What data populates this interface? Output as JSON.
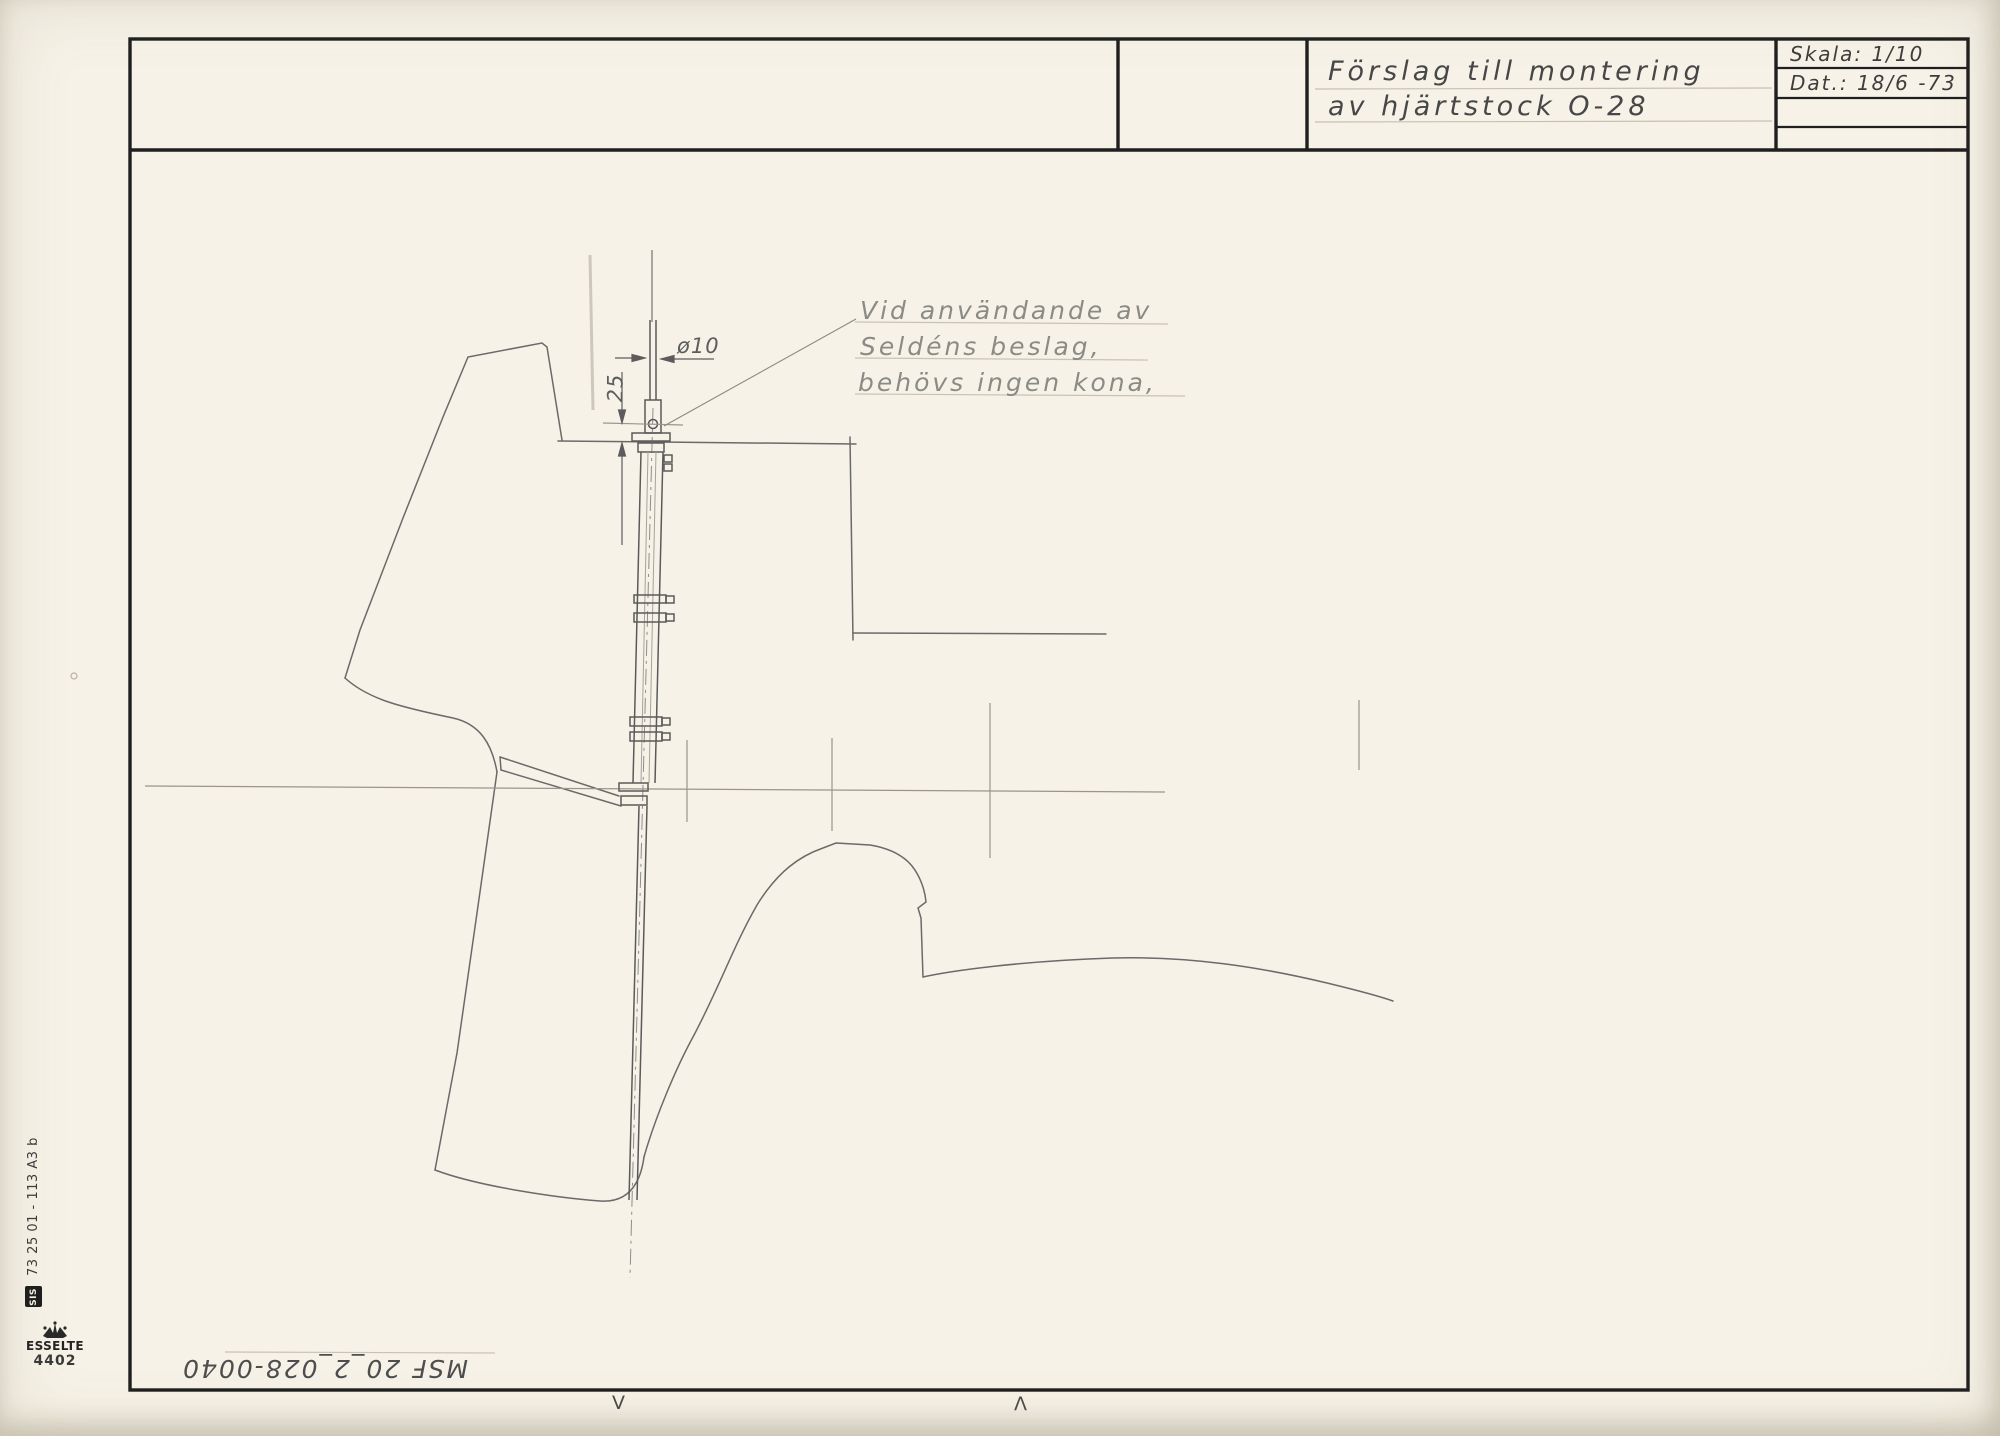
{
  "colors": {
    "paper": "#f6f2e7",
    "ink": "#1f1f1f",
    "pencil": "#6a6a6a",
    "pencil_light": "#a39d91",
    "hand_dark": "#474747",
    "hand_light": "#8b8b86"
  },
  "title_block": {
    "title_line1": "Förslag till montering",
    "title_line2": "av hjärtstock O-28",
    "scale_label": "Skala: 1/10",
    "date_label": "Dat.: 18/6 -73"
  },
  "annotation": {
    "line1": "Vid användande av",
    "line2": "Seldéns beslag,",
    "line3": "behövs ingen kona,"
  },
  "dimensions": {
    "diameter": "ø10",
    "offset": "25"
  },
  "stamps": {
    "form_ref": "73 25 01 - 113 A3 b",
    "sis": "SIS",
    "brand": "ESSELTE",
    "brand_number": "4402",
    "doc_number": "MSF 20_2_028-0040",
    "reg_mark_down": "V",
    "reg_mark_up": "Λ"
  }
}
